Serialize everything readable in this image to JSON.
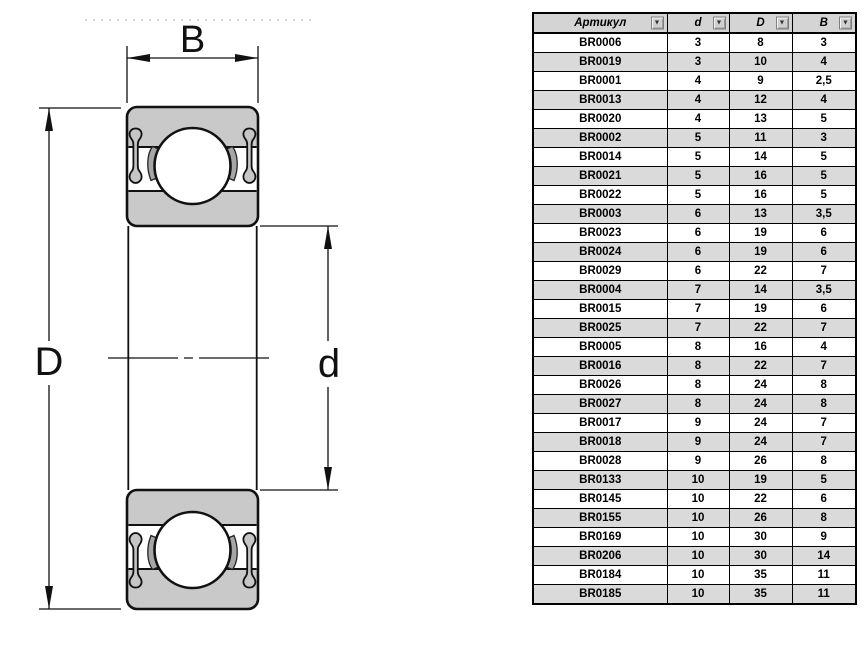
{
  "drawing": {
    "label_width": "B",
    "label_outer_diameter": "D",
    "label_bore_diameter": "d"
  },
  "table": {
    "headers": [
      "Артикул",
      "d",
      "D",
      "B"
    ],
    "filter_icon": "▼",
    "rows": [
      [
        "BR0006",
        "3",
        "8",
        "3"
      ],
      [
        "BR0019",
        "3",
        "10",
        "4"
      ],
      [
        "BR0001",
        "4",
        "9",
        "2,5"
      ],
      [
        "BR0013",
        "4",
        "12",
        "4"
      ],
      [
        "BR0020",
        "4",
        "13",
        "5"
      ],
      [
        "BR0002",
        "5",
        "11",
        "3"
      ],
      [
        "BR0014",
        "5",
        "14",
        "5"
      ],
      [
        "BR0021",
        "5",
        "16",
        "5"
      ],
      [
        "BR0022",
        "5",
        "16",
        "5"
      ],
      [
        "BR0003",
        "6",
        "13",
        "3,5"
      ],
      [
        "BR0023",
        "6",
        "19",
        "6"
      ],
      [
        "BR0024",
        "6",
        "19",
        "6"
      ],
      [
        "BR0029",
        "6",
        "22",
        "7"
      ],
      [
        "BR0004",
        "7",
        "14",
        "3,5"
      ],
      [
        "BR0015",
        "7",
        "19",
        "6"
      ],
      [
        "BR0025",
        "7",
        "22",
        "7"
      ],
      [
        "BR0005",
        "8",
        "16",
        "4"
      ],
      [
        "BR0016",
        "8",
        "22",
        "7"
      ],
      [
        "BR0026",
        "8",
        "24",
        "8"
      ],
      [
        "BR0027",
        "8",
        "24",
        "8"
      ],
      [
        "BR0017",
        "9",
        "24",
        "7"
      ],
      [
        "BR0018",
        "9",
        "24",
        "7"
      ],
      [
        "BR0028",
        "9",
        "26",
        "8"
      ],
      [
        "BR0133",
        "10",
        "19",
        "5"
      ],
      [
        "BR0145",
        "10",
        "22",
        "6"
      ],
      [
        "BR0155",
        "10",
        "26",
        "8"
      ],
      [
        "BR0169",
        "10",
        "30",
        "9"
      ],
      [
        "BR0206",
        "10",
        "30",
        "14"
      ],
      [
        "BR0184",
        "10",
        "35",
        "11"
      ],
      [
        "BR0185",
        "10",
        "35",
        "11"
      ]
    ]
  },
  "colors": {
    "bearing_fill": "#c9c9c9",
    "seal_fill": "#c6c6c6",
    "cage_fill": "#a6a6a6",
    "line": "#111111",
    "table_header_bg": "#d4d4d4",
    "table_alt_row_bg": "#dadada"
  }
}
